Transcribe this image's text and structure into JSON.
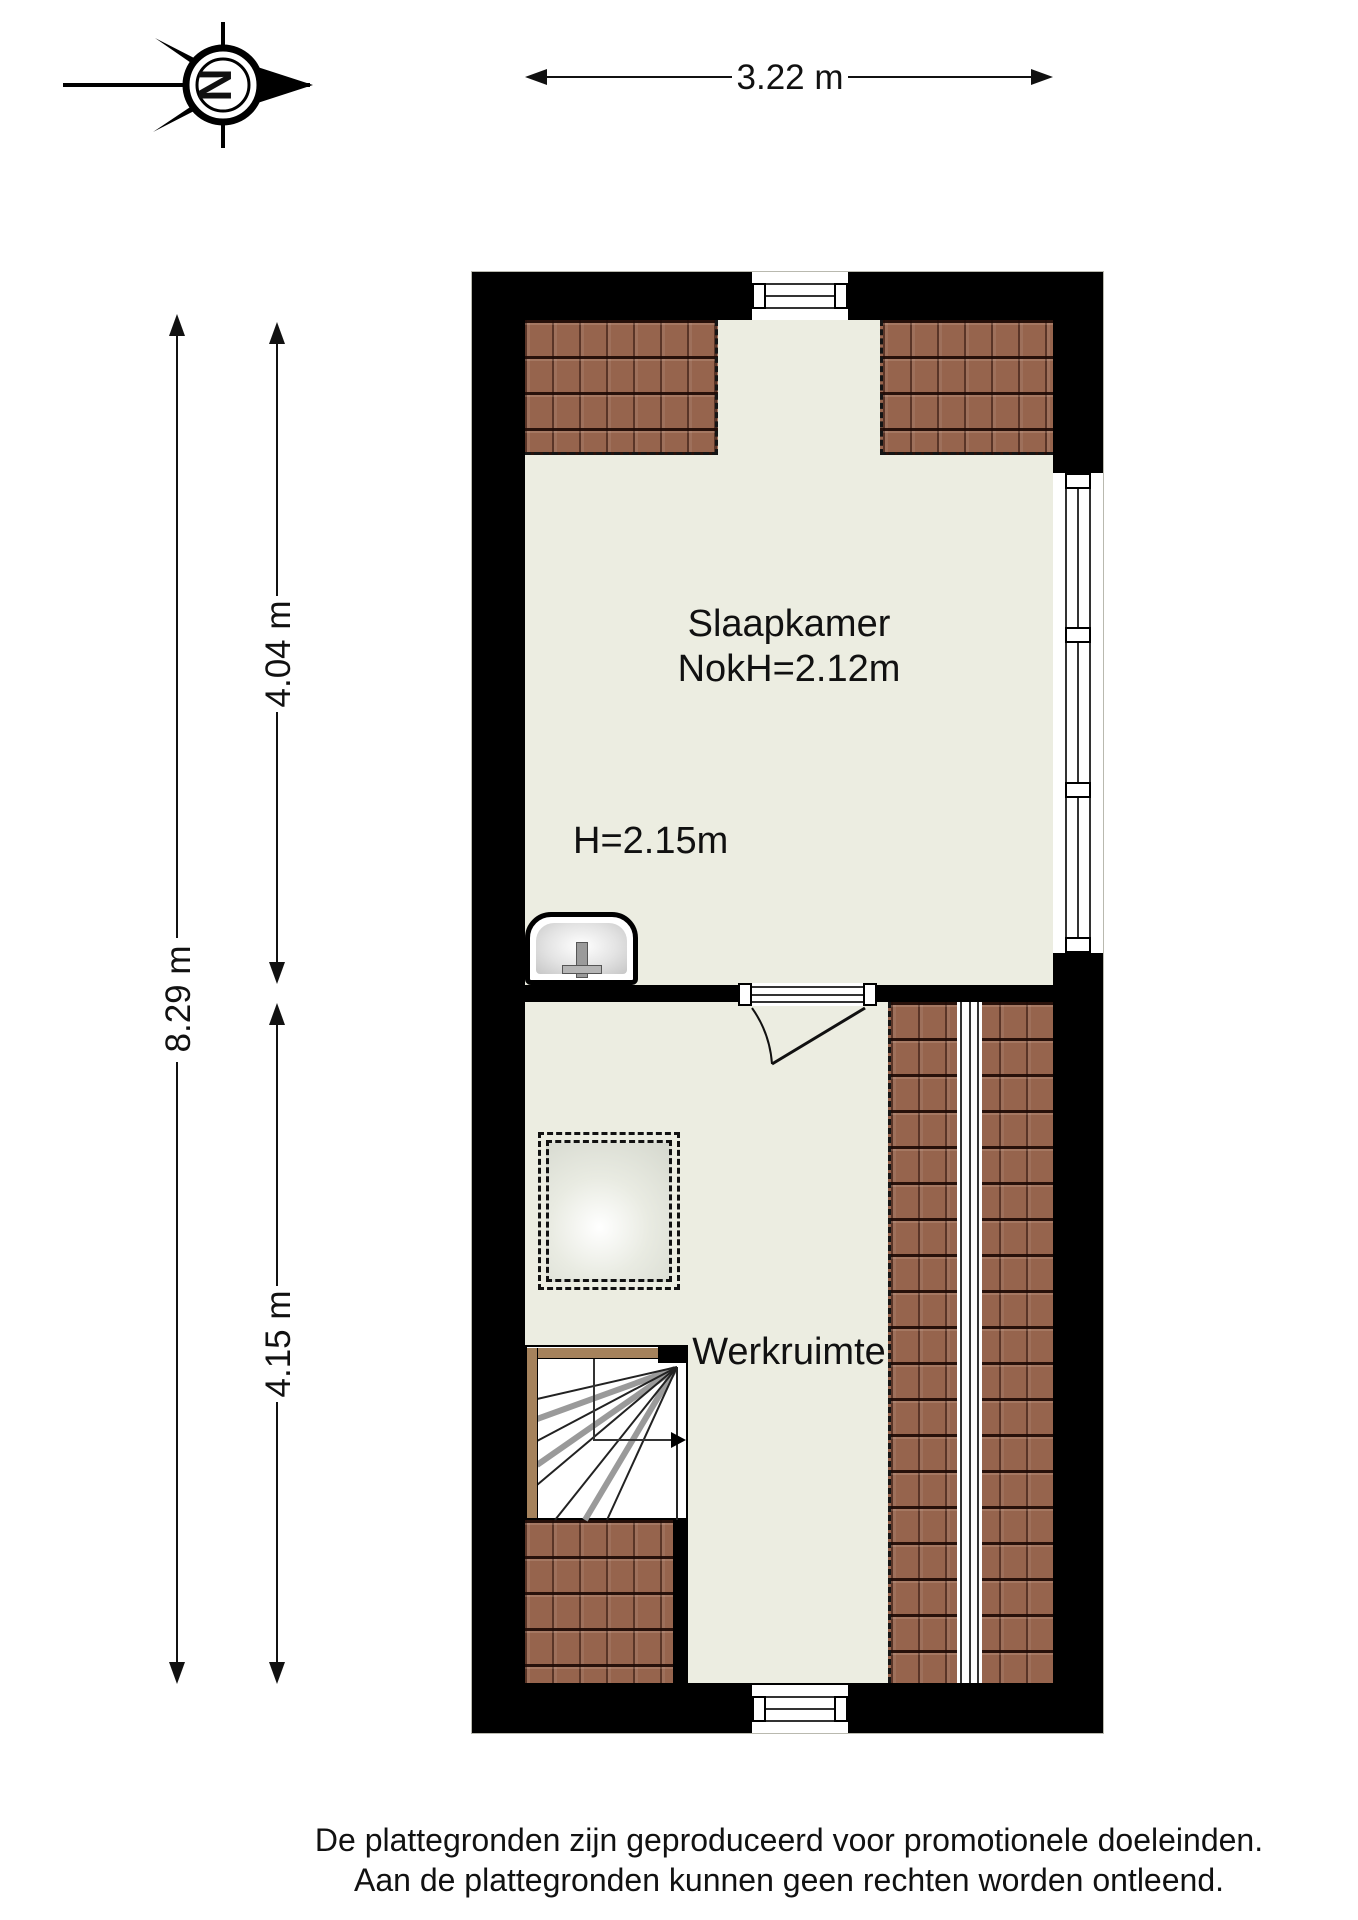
{
  "compass": {
    "letter": "N"
  },
  "dimensions": {
    "width_top": "3.22 m",
    "height_total": "8.29 m",
    "height_slaapkamer": "4.04 m",
    "height_werkruimte": "4.15 m"
  },
  "rooms": {
    "slaapkamer": {
      "name": "Slaapkamer",
      "ridge_height": "NokH=2.12m",
      "ceiling_height": "H=2.15m"
    },
    "werkruimte": {
      "name": "Werkruimte"
    }
  },
  "footer": {
    "line1": "De plattegronden zijn geproduceerd voor promotionele doeleinden.",
    "line2": "Aan de plattegronden kunnen geen rechten worden ontleend."
  },
  "colors": {
    "background": "#ffffff",
    "wall": "#000000",
    "floor": "#ecede1",
    "tile_base": "#96644d",
    "stairs_wood": "#a5825c",
    "dimension": "#1a1a1a"
  }
}
